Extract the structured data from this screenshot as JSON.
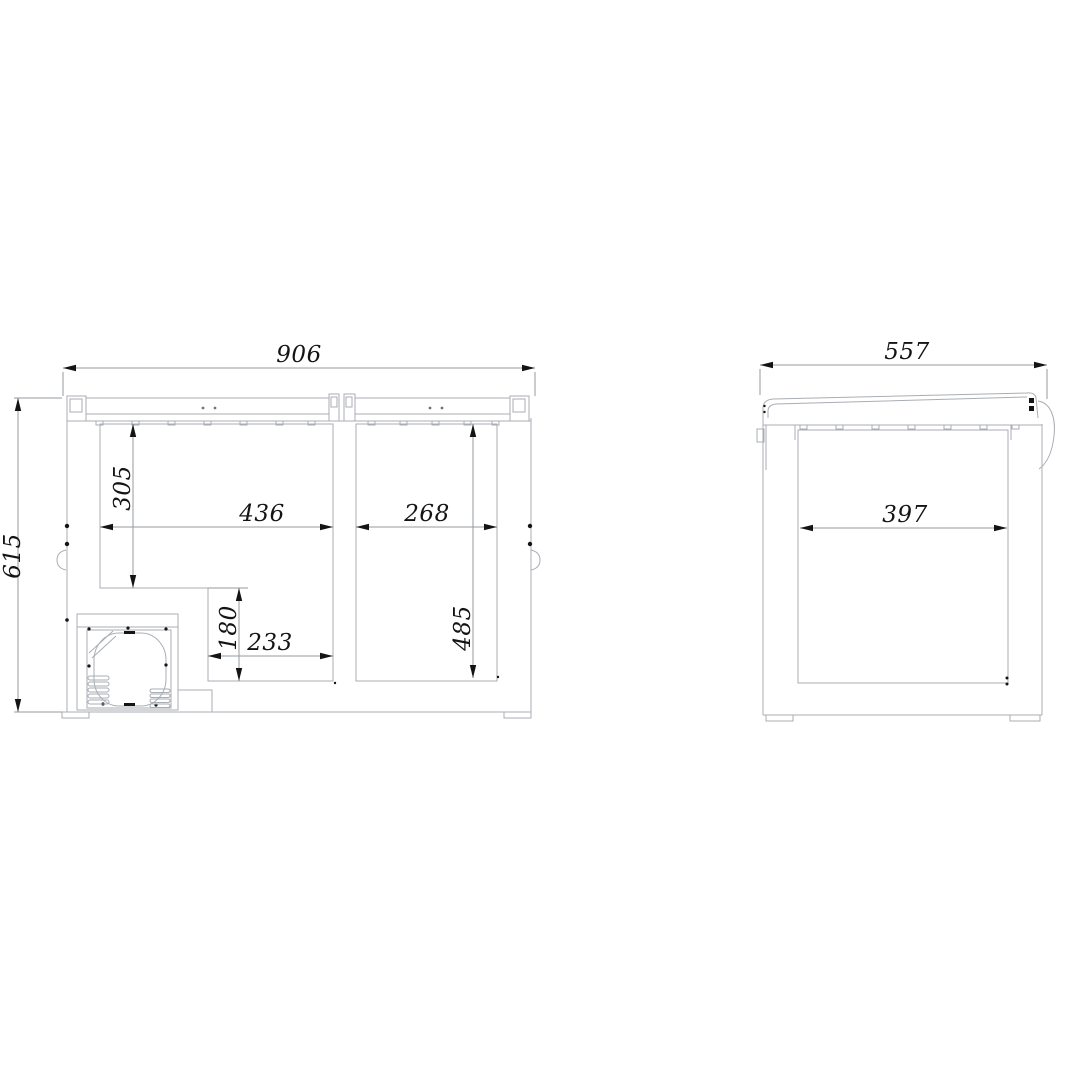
{
  "drawing": {
    "views": {
      "front_section": {
        "dimensions": {
          "overall_width": "906",
          "overall_height": "615",
          "left_depth_to_step": "305",
          "left_width": "436",
          "right_width": "268",
          "step_width": "233",
          "step_depth": "180",
          "right_depth": "485"
        }
      },
      "side_section": {
        "dimensions": {
          "overall_depth": "557",
          "interior_depth": "397"
        }
      }
    },
    "colors": {
      "background": "#ffffff",
      "outline": "#a9aeb4",
      "dimension_line": "#959ba1",
      "annotation": "#141414"
    }
  }
}
